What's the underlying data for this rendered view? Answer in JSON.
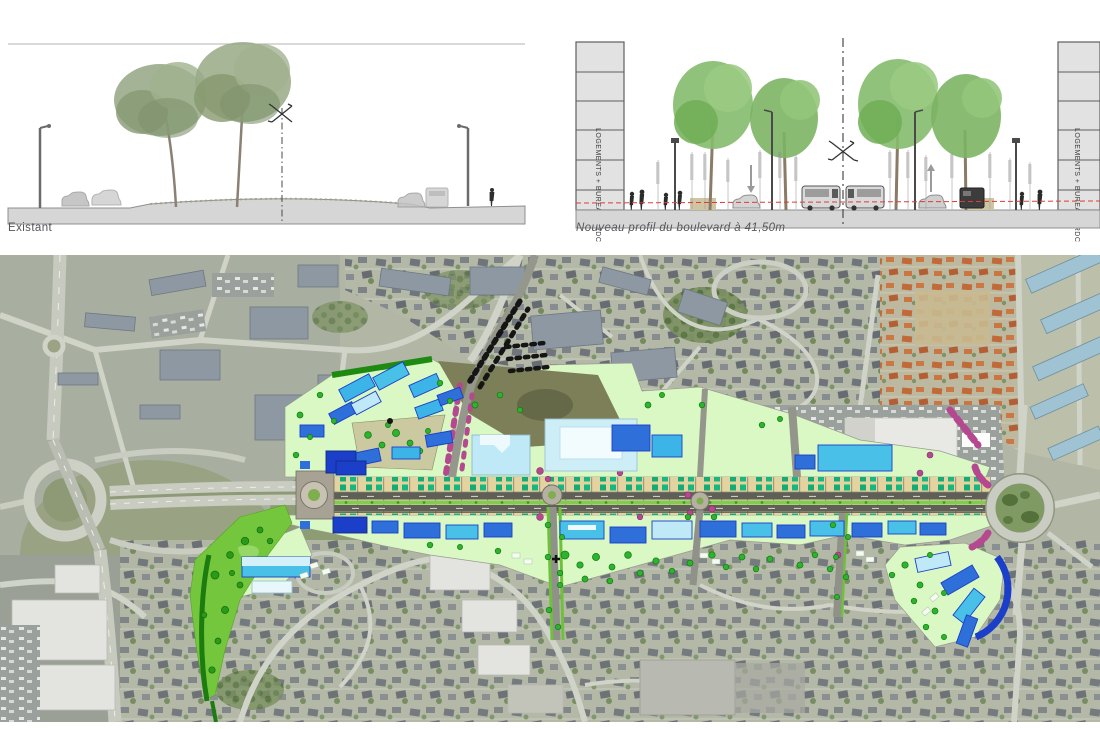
{
  "document": {
    "sections": {
      "existant": {
        "label": "Existant"
      },
      "nouveau": {
        "label": "Nouveau profil du boulevard à 41,50m",
        "left_building_label": "LOGEMENTS + BUREAUX RDC",
        "right_building_label": "LOGEMENTS + BUREAUX RDC"
      }
    },
    "map": {
      "description_colors": {
        "plan_pale_green": "#d9f8c4",
        "plan_bright_green": "#74c63c",
        "boulevard_tan": "#e5d5a1",
        "carriageway_gray": "#5e5f57",
        "tree_teal": "#12ac74",
        "tree_green": "#2db32d",
        "tree_magenta": "#b5498f",
        "building_navy": "#1b3fc8",
        "building_blue": "#2e6fd9",
        "building_cyan": "#49c0e8",
        "building_pale_blue": "#bfe9f6",
        "aerial_base": "#b2b7a5",
        "section_ground": "#d6d6d6",
        "red_dashed_line": "#e03a3a"
      }
    }
  }
}
